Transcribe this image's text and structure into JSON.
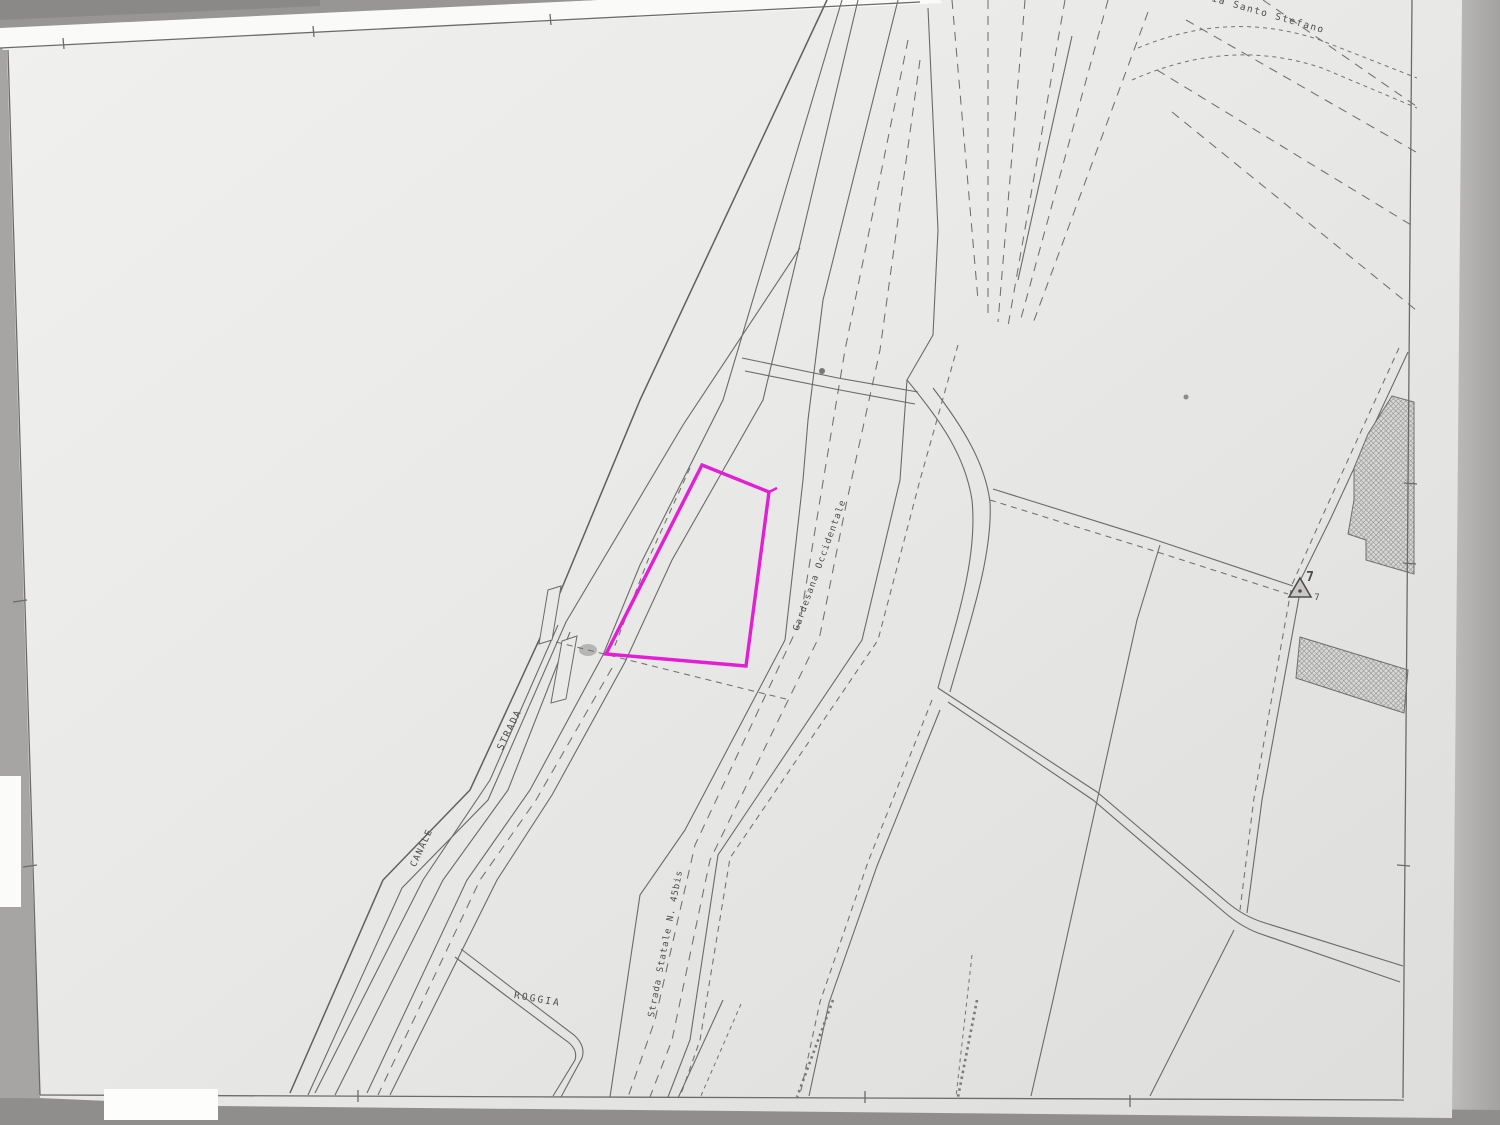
{
  "document": {
    "kind": "scanned cadastral map sheet",
    "sheet_note": "photocopied catastal plan with highlighted parcel"
  },
  "map": {
    "colors": {
      "paper": "#e9e9e7",
      "scanner_background": "#a6a5a3",
      "bottom_margin": "#8f8e8c",
      "drawing_line": "#6a6a68",
      "highlight": "#e31fd4",
      "hatch_fill": "#d8d8d6",
      "paper_edge_highlight": "#fafaf8"
    },
    "labels": [
      {
        "id": "label-via-santo-stefano",
        "text": "Via Santo Stefano",
        "x": 1264,
        "y": 16,
        "rotation": 16,
        "size": 9.5,
        "spacing": 1.6
      },
      {
        "id": "label-gardesana-occidentale",
        "text": "Gardesana Occidentale",
        "x": 822,
        "y": 566,
        "rotation": -70,
        "size": 9,
        "spacing": 1.2
      },
      {
        "id": "label-strada",
        "text": "STRADA",
        "x": 512,
        "y": 731,
        "rotation": -64,
        "size": 9.5,
        "spacing": 1.6
      },
      {
        "id": "label-canale",
        "text": "CANALE",
        "x": 424,
        "y": 849,
        "rotation": -65,
        "size": 9,
        "spacing": 1.4
      },
      {
        "id": "label-roggia",
        "text": "ROGGIA",
        "x": 537,
        "y": 1002,
        "rotation": 10,
        "size": 9.5,
        "spacing": 2.2
      },
      {
        "id": "label-strada-statale-45bis",
        "text": "Strada Statale N. 45bis",
        "x": 668,
        "y": 944,
        "rotation": -79,
        "size": 9,
        "spacing": 1.1
      },
      {
        "id": "label-survey-point-7",
        "text": "7",
        "x": 1310,
        "y": 581,
        "rotation": 0,
        "size": 13,
        "spacing": 0,
        "bold": true
      },
      {
        "id": "label-survey-point-7-small",
        "text": "7",
        "x": 1317,
        "y": 600,
        "rotation": 0,
        "size": 9,
        "spacing": 0
      }
    ],
    "highlight_parcel": {
      "description": "parcel outlined in magenta highlighter",
      "color": "#e31fd4",
      "points": "702,465 769,492 746,666 606,654"
    },
    "survey_marker": {
      "symbol": "triangle-with-dot",
      "number": "7"
    }
  }
}
